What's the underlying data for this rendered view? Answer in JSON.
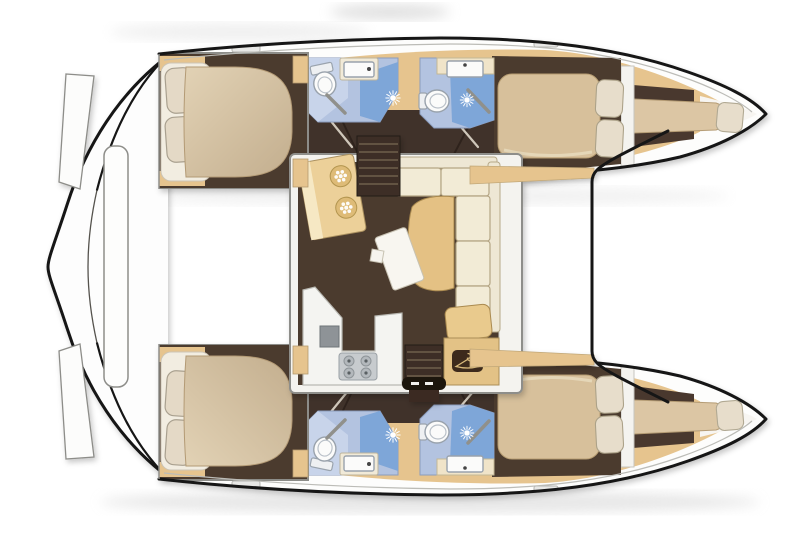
{
  "title": "Catamaran interior layout floor plan (top view)",
  "colors": {
    "outline": "#161616",
    "deck_white": "#fdfdfc",
    "wood_tan": "#e6c48e",
    "floor_dark_brown": "#4c3b2f",
    "corridor_brown": "#41332a",
    "mattress_beige": "#d0bd9f",
    "pillow_cream": "#e7ddcb",
    "bathroom_blue": "#b3c3e0",
    "shower_blue": "#7ea6d8",
    "fixture_white": "#fbfbfa",
    "counter_white": "#f4f4f1",
    "stove_gray": "#c7cbce",
    "sofa_cream": "#f2ebd6",
    "chaise_tan": "#e4c184",
    "table_white": "#f8f6f0",
    "wardrobe_badge_brown": "#3e2c1d",
    "hanger_tan": "#d9ba7c"
  },
  "icons": {
    "shower_icon": "white sunburst spray",
    "toilet_icon": "white oval bowl with tank",
    "sink_icon": "white rectangular basin with faucet dot",
    "round_sink_icon": "tan circle with white six-petal flower",
    "stove_icon": "gray hob with four burner rings",
    "wardrobe_icon": "clothes hanger on dark badge",
    "deck_hatch_icon": "small gray rounded rectangle"
  },
  "layout": {
    "orientation": "bows to the right, sterns to the left",
    "port_hull": [
      "aft double cabin",
      "aft bathroom with shower",
      "forward bathroom with shower",
      "forward double cabin",
      "forepeak berth"
    ],
    "starboard_hull": [
      "aft double cabin",
      "aft bathroom with shower",
      "forward bathroom with shower",
      "forward double cabin",
      "forepeak berth"
    ],
    "saloon": [
      "galley with twin round sinks",
      "four-burner stove and fridge",
      "L-shaped sofa with chaise",
      "dining table",
      "wardrobe",
      "companionway stairs to each hull"
    ],
    "foredeck": [
      "forward crossbeam edge"
    ],
    "stern": [
      "transom steps",
      "aft platform beam"
    ]
  }
}
